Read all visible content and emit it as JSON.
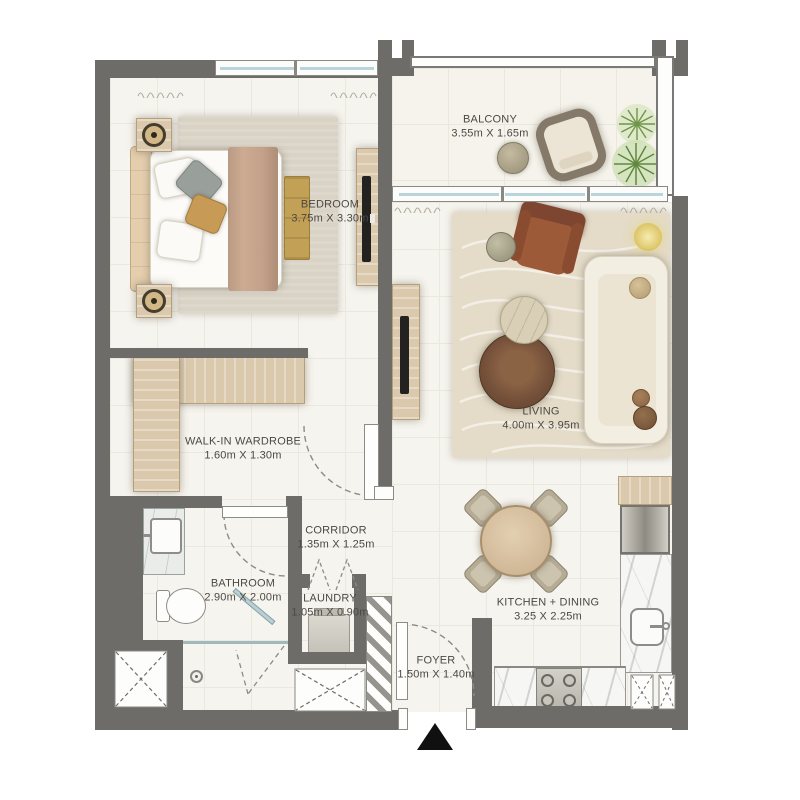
{
  "rooms": {
    "bedroom": {
      "name": "BEDROOM",
      "dims": "3.75m X 3.30m"
    },
    "balcony": {
      "name": "BALCONY",
      "dims": "3.55m X 1.65m"
    },
    "living": {
      "name": "LIVING",
      "dims": "4.00m X 3.95m"
    },
    "wardrobe": {
      "name": "WALK-IN WARDROBE",
      "dims": "1.60m X 1.30m"
    },
    "corridor": {
      "name": "CORRIDOR",
      "dims": "1.35m X 1.25m"
    },
    "bathroom": {
      "name": "BATHROOM",
      "dims": "2.90m X 2.00m"
    },
    "laundry": {
      "name": "LAUNDRY",
      "dims": "1.05m X 0.90m"
    },
    "kitchen": {
      "name": "KITCHEN + DINING",
      "dims": "3.25 X 2.25m"
    },
    "foyer": {
      "name": "FOYER",
      "dims": "1.50m X 1.40m"
    }
  },
  "colors": {
    "wall": "#6e6c68",
    "floor": "#f6f4ee",
    "wood": "#dbc9ae",
    "living_rug": "#e4dcc9",
    "bedroom_rug": "#d9d3c5",
    "leather_chair": "#9b5a38",
    "plant_green": "#6e9549",
    "glass": "#b9d4da",
    "label_text": "#4b4944"
  }
}
